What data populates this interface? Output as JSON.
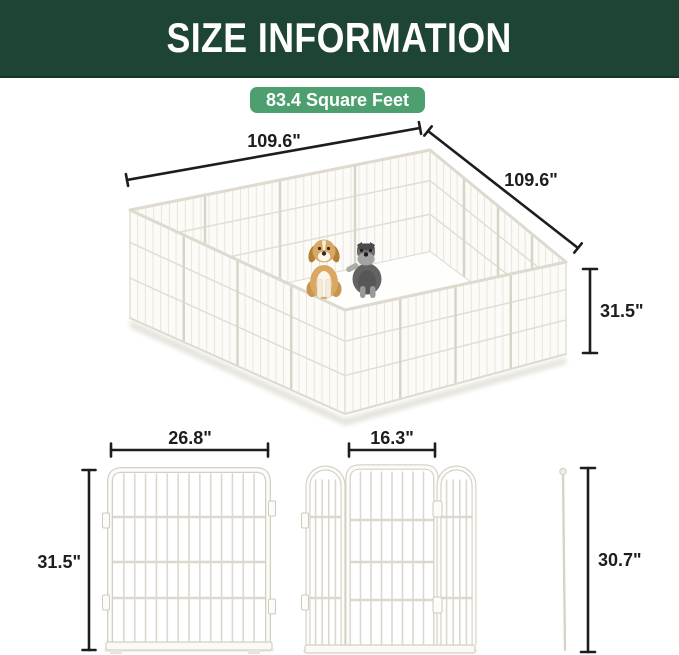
{
  "header": {
    "title": "SIZE INFORMATION"
  },
  "badge": {
    "label": "83.4 Square Feet"
  },
  "pen": {
    "width_label": "109.6\"",
    "depth_label": "109.6\"",
    "height_label": "31.5\"",
    "contents": [
      "tan-puppy",
      "grey-schnauzer"
    ]
  },
  "panel": {
    "width_label": "26.8\"",
    "height_label": "31.5\""
  },
  "door": {
    "width_label": "16.3\""
  },
  "pole": {
    "height_label": "30.7\""
  },
  "colors": {
    "header_bg": "#1e4434",
    "badge_bg": "#4d9f70",
    "dimension_ink": "#1d1d1b",
    "fence_fill": "#fcfbf8",
    "fence_outline": "#d9d5ca"
  }
}
